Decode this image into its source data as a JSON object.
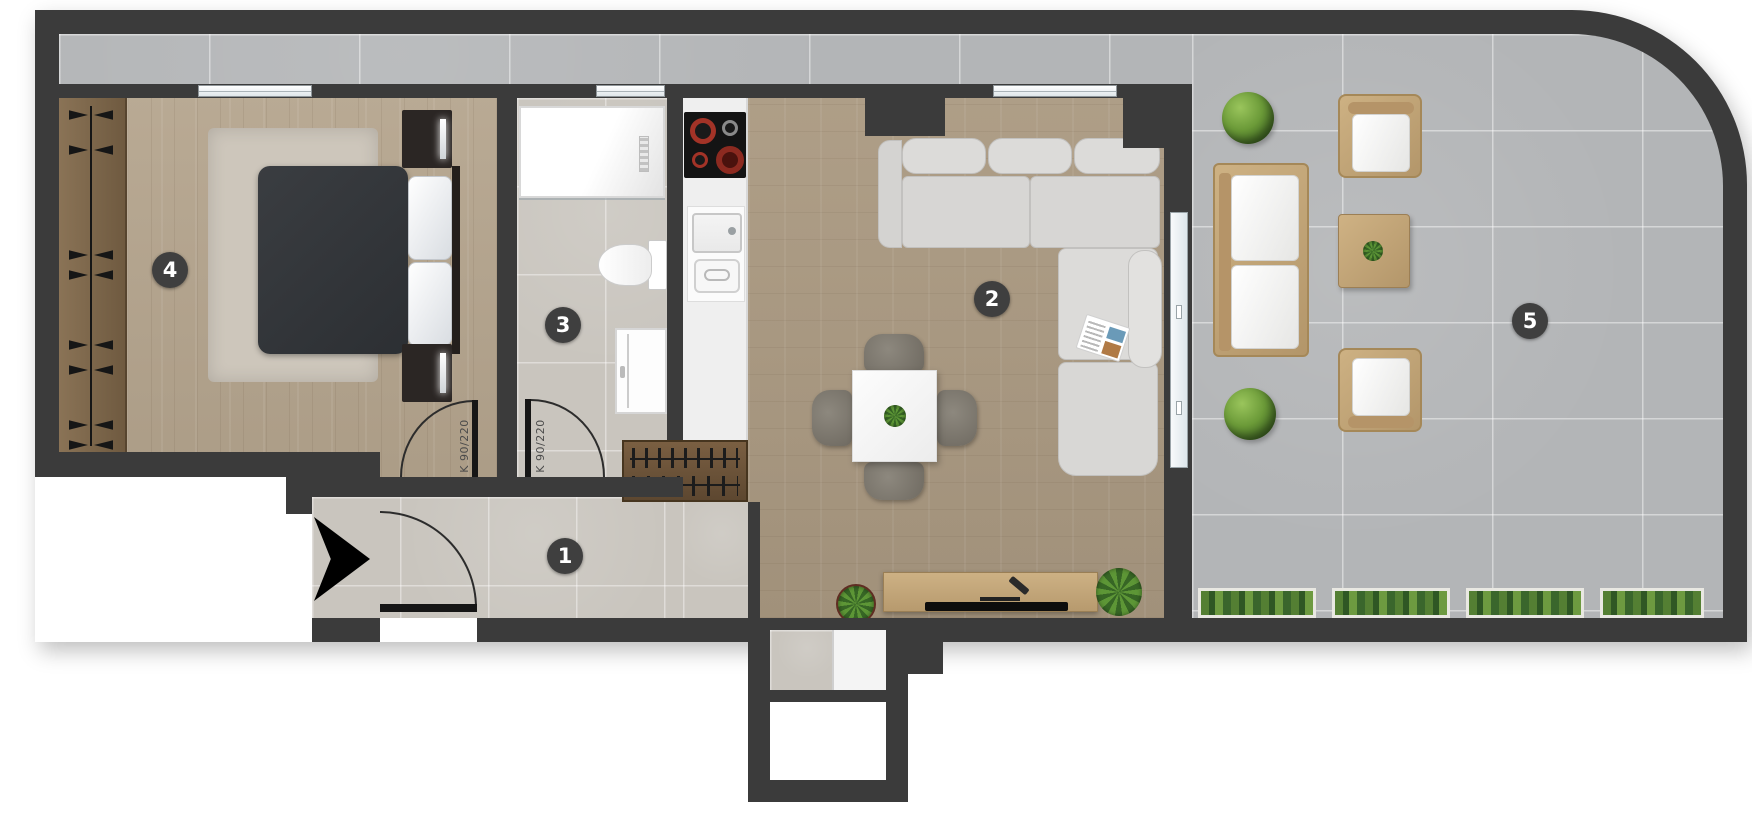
{
  "title": "Apartment floor plan",
  "rooms": [
    {
      "number": "1",
      "name": "hallway"
    },
    {
      "number": "2",
      "name": "living-room-kitchen"
    },
    {
      "number": "3",
      "name": "bathroom"
    },
    {
      "number": "4",
      "name": "bedroom"
    },
    {
      "number": "5",
      "name": "terrace"
    }
  ],
  "doors": [
    {
      "label": "K 90/220"
    },
    {
      "label": "K 90/220"
    }
  ],
  "icons": {
    "entry_arrow": "chevron-right"
  },
  "colors": {
    "wall": "#3b3b3b",
    "wood_bedroom": "#b5a58e",
    "wood_living": "#ab9a82",
    "tile_interior": "#c9c5be",
    "tile_terrace": "#b3b5b7",
    "badge": "#3f3f3f",
    "plant_green": "#5d9636",
    "outdoor_frame_wood": "#c3a576"
  }
}
